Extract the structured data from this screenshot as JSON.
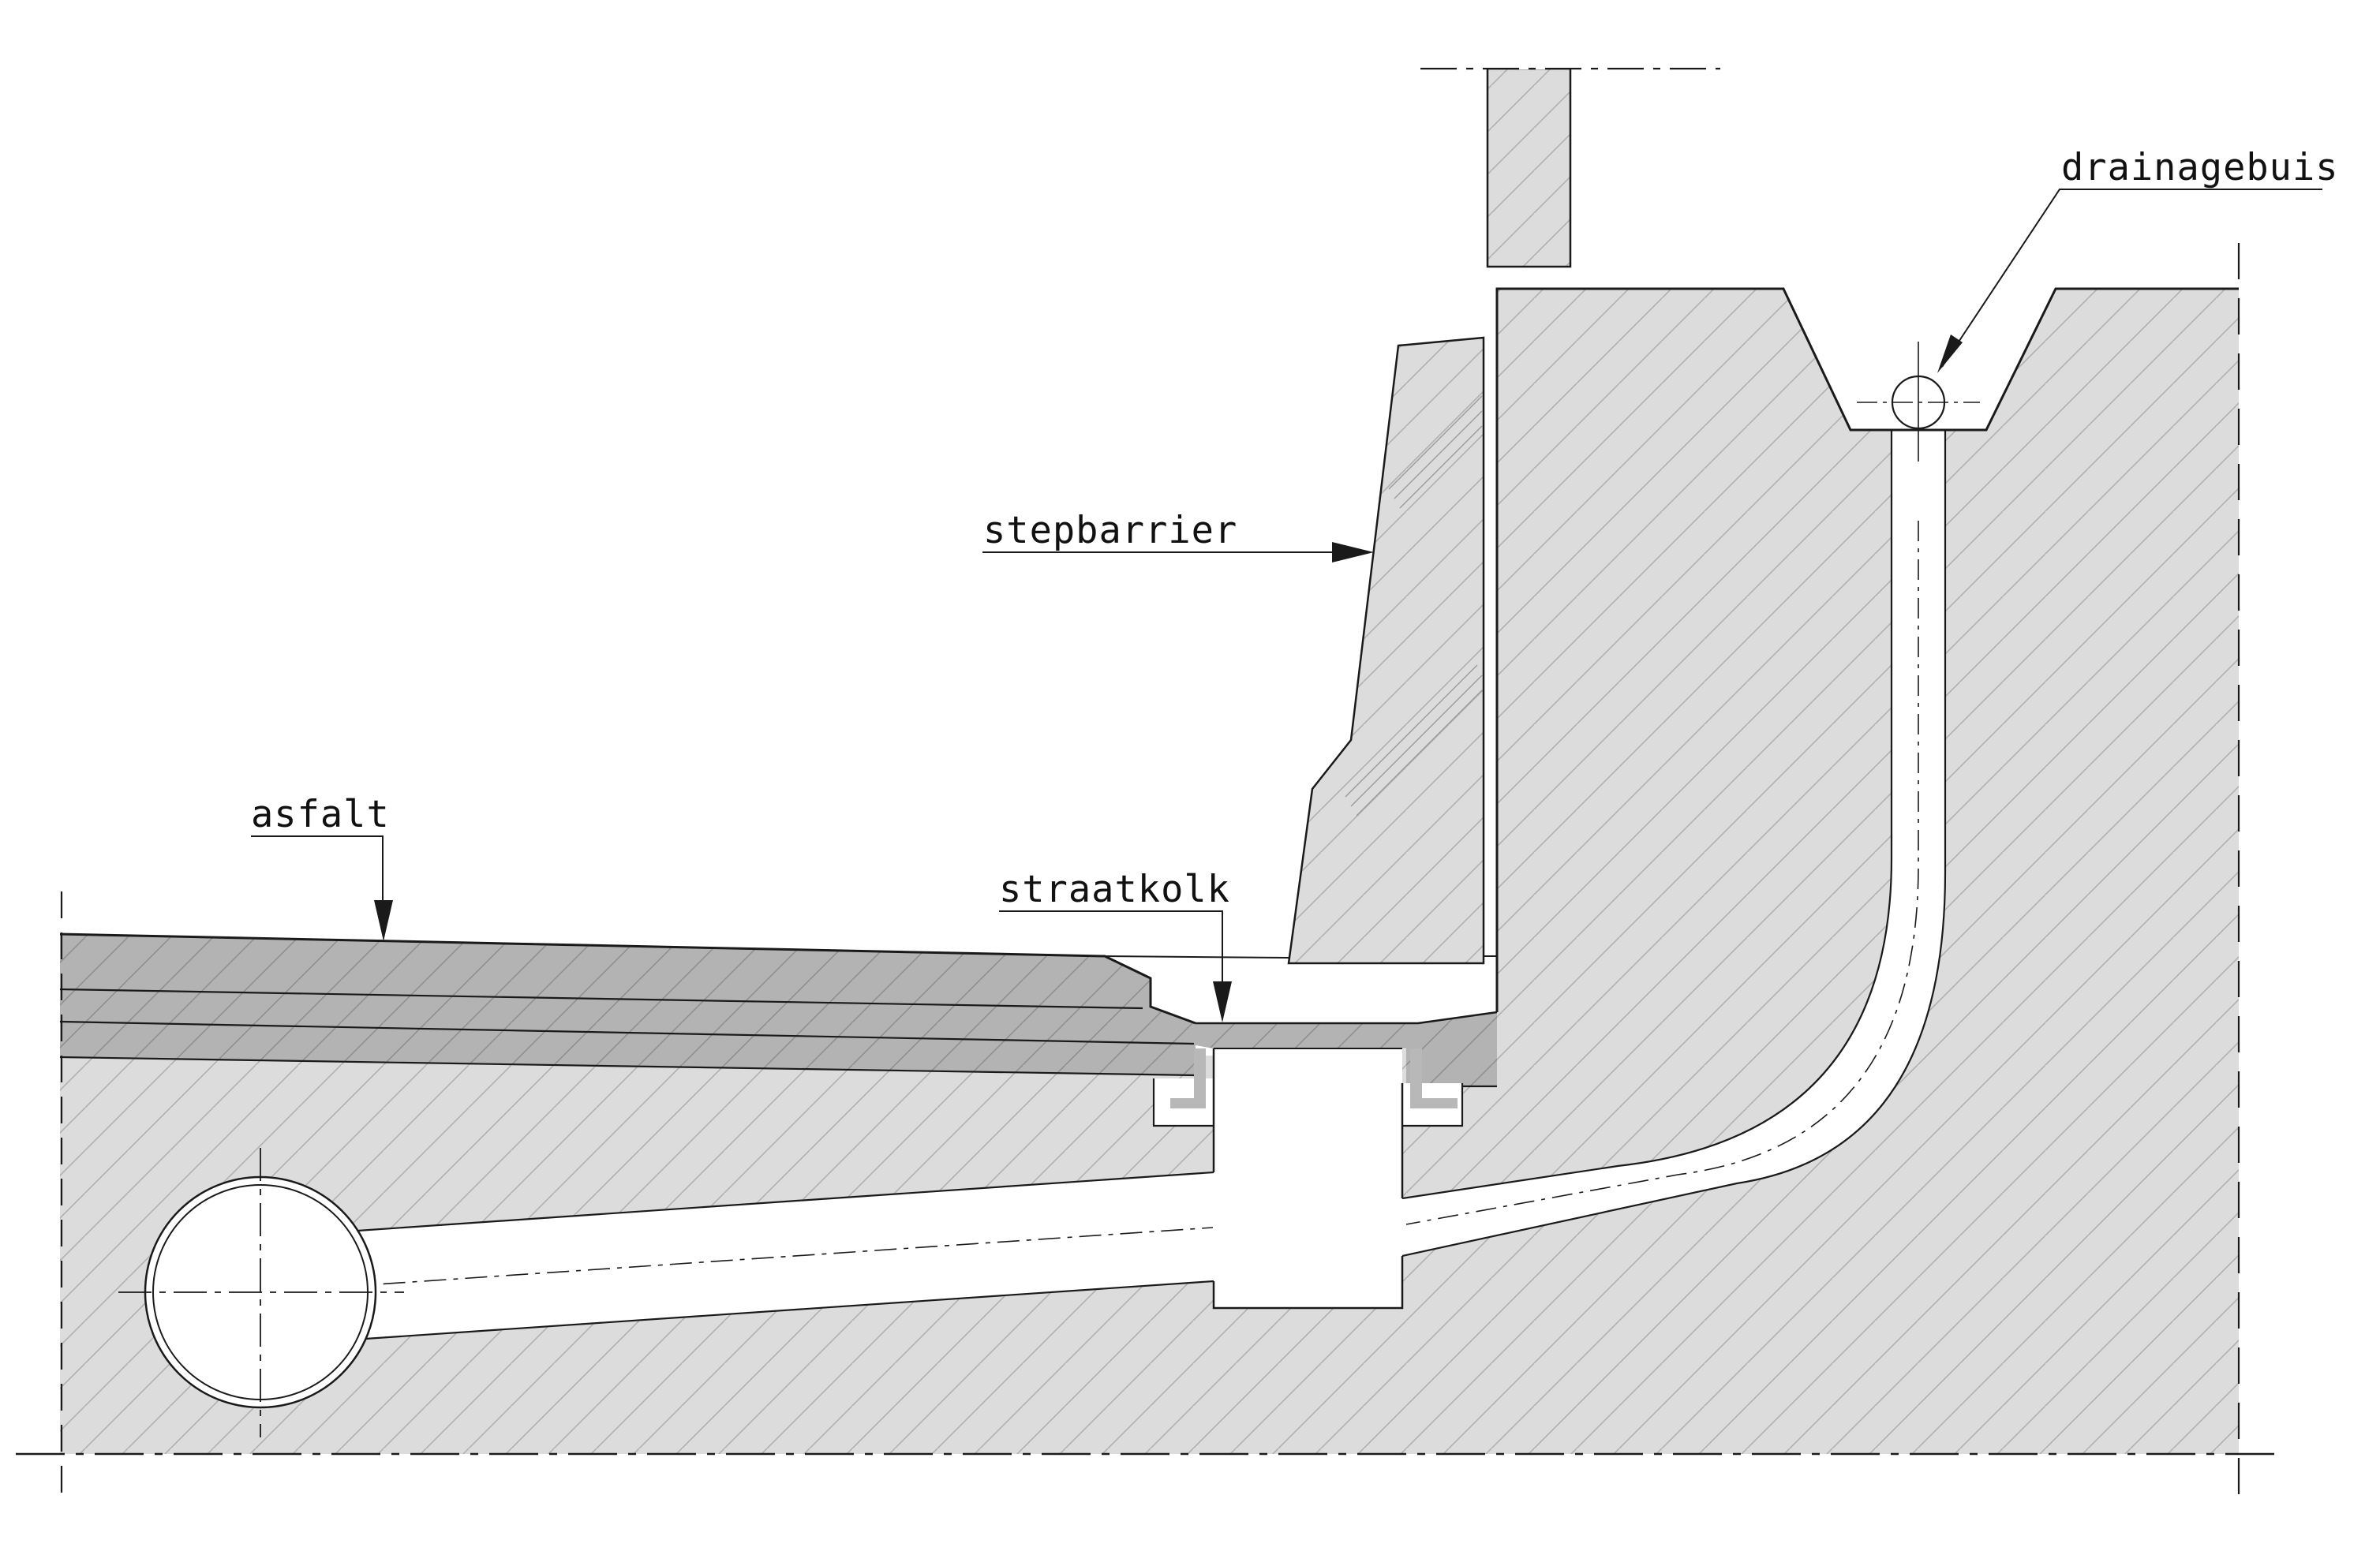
{
  "drawing": {
    "kind": "technical cross-section (CAD)",
    "language": "Dutch",
    "subject": "road edge with step barrier, street gully and drainage pipe"
  },
  "labels": {
    "drainagebuis": {
      "text": "drainagebuis",
      "target": "small drainage pipe circle in V-notch"
    },
    "stepbarrier": {
      "text": "stepbarrier",
      "target": "concrete step barrier element"
    },
    "asfalt": {
      "text": "asfalt",
      "target": "asphalt road surface"
    },
    "straatkolk": {
      "text": "straatkolk",
      "target": "street gully inlet"
    }
  },
  "colors": {
    "background": "#ffffff",
    "ground_fill": "#dcdcdc",
    "ground_hatch": "#b0b0b0",
    "asphalt_fill": "#b3b3b3",
    "asphalt_hatch": "#8f8f8f",
    "curb_fill": "#b8b8b8",
    "outline": "#1a1a1a"
  }
}
